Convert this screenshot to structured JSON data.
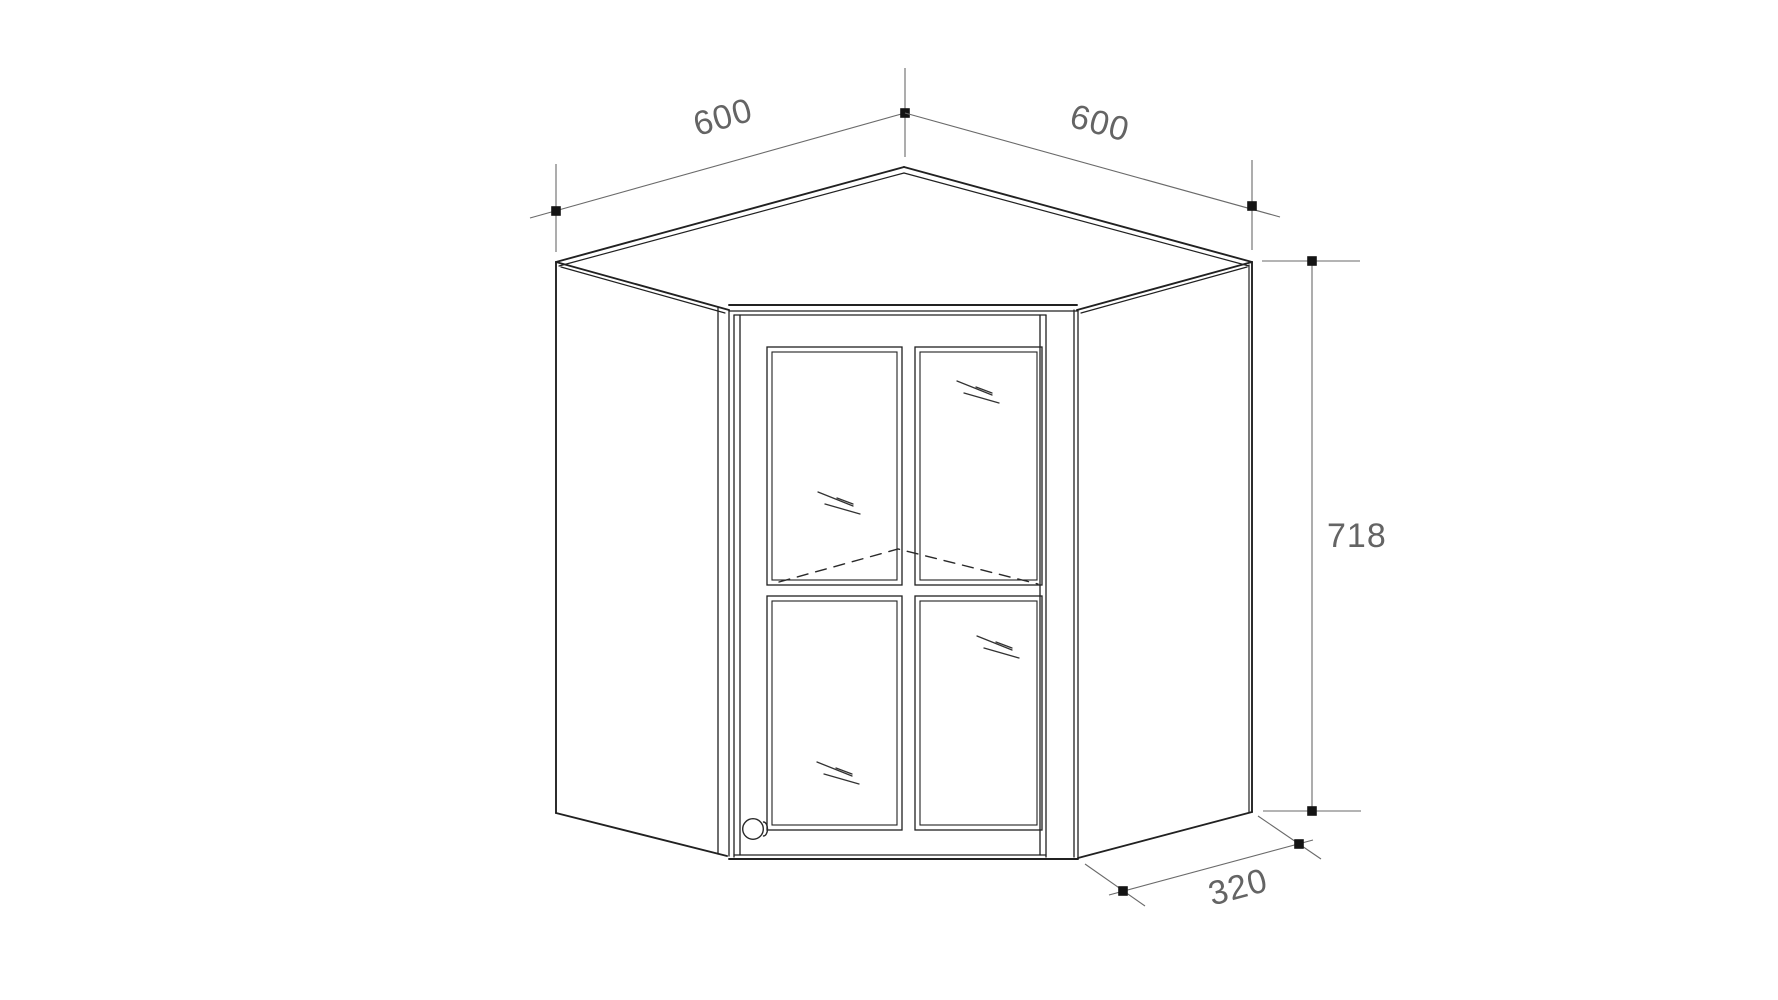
{
  "drawing": {
    "title": "Corner wall cabinet with glazed door - dimensioned line drawing",
    "dimensions": {
      "top_left_width": "600",
      "top_right_width": "600",
      "height": "718",
      "side_depth": "320"
    },
    "colors": {
      "outline": "#212121",
      "detail_line": "#2e2e2e",
      "dimension_line": "#6a6a6a",
      "dimension_text": "#646464",
      "marker_dot": "#141414",
      "background": "#ffffff"
    }
  }
}
